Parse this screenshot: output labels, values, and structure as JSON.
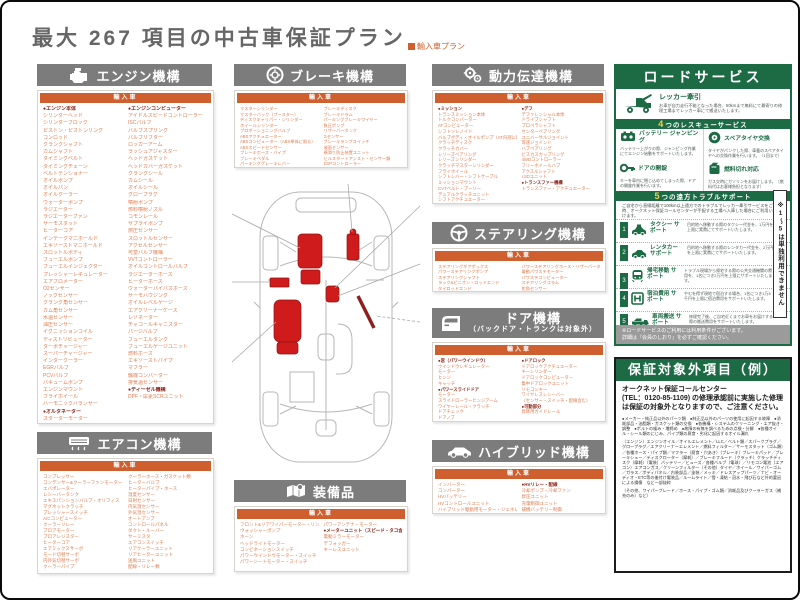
{
  "page": {
    "title": "最大 267 項目の中古車保証プラン",
    "plan_badge": "輸入車プラン"
  },
  "colors": {
    "accent_orange": "#cf5f2e",
    "header_gray": "#7c7c7c",
    "green": "#1d6b45",
    "part_red": "#c61a1a"
  },
  "sections": {
    "engine": {
      "title": "エンジン機構",
      "subheader": "輸入車",
      "col1": [
        "●エンジン本体",
        "シリンダーヘッド",
        "シリンダーブロック",
        "ピストン・ピストンリング",
        "コンロッド",
        "クランクシャフト",
        "カムシャフト",
        "タイミングベルト",
        "タイミングチェーン",
        "ベルトテンショナー",
        "オイルポンプ",
        "オイルパン",
        "オイルクーラー",
        "ウォーターポンプ",
        "ラジエーター",
        "ラジエーターファン",
        "サーモスタット",
        "ヒーターコア",
        "インテークマニホールド",
        "エキゾーストマニホールド",
        "スロットルボディ",
        "フューエルポンプ",
        "フューエルインジェクター",
        "プレッシャーレギュレーター",
        "エアフロメーター",
        "O2センサー",
        "ノックセンサー",
        "クランク角センサー",
        "カム角センサー",
        "水温センサー",
        "油圧センサー",
        "イグニッションコイル",
        "ディストリビューター",
        "ターボチャージャー",
        "スーパーチャージャー",
        "インタークーラー",
        "EGRバルブ",
        "PCVバルブ",
        "バキュームポンプ",
        "エンジンマウント",
        "フライホイール",
        "ハーモニックバランサー",
        "●オルタネーター",
        "スターターモーター"
      ],
      "col2": [
        "●エンジンコンピューター",
        "アイドルスピードコントローラー",
        "ISCバルブ",
        "バルブスプリング",
        "バルブリフター",
        "ロッカーアーム",
        "ラッシュアジャスター",
        "ヘッドガスケット",
        "ヘッドカバーガスケット",
        "クランクシール",
        "カムシール",
        "オイルシール",
        "グロープラグ",
        "噴射ポンプ",
        "燃料噴射ノズル",
        "コモンレール",
        "サプライポンプ",
        "燃圧センサー",
        "スロットルセンサー",
        "アクセルセンサー",
        "可変バルブ機構",
        "VVTコントローラー",
        "オイルコントロールバルブ",
        "ラジエーターホース",
        "ヒーターホース",
        "ウォーターバイパスホース",
        "サーモハウジング",
        "オイルレベルゲージ",
        "エアクリーナーケース",
        "レゾネーター",
        "チャコールキャニスター",
        "パージバルブ",
        "フューエルタンク",
        "フューエルゲージユニット",
        "燃料ホース",
        "エキゾーストパイプ",
        "マフラー",
        "触媒コンバーター",
        "排気温センサー",
        "●ディーゼル機構",
        "DPF・尿素SCRユニット"
      ]
    },
    "brake": {
      "title": "ブレーキ機構",
      "subheader": "輸入車",
      "col1": [
        "マスターシリンダー",
        "マスターバック（ブースター）",
        "ディスクキャリパー・シリンダー",
        "ホイールシリンダー",
        "プロポーショニングバルブ",
        "ABSアクチュエーター",
        "ABSコンピューター（ABS単体に限る）",
        "ABSスピードセンサー",
        "ブレーキホース・パイプ",
        "ブレーキペダル",
        "パーキングブレーキレバー"
      ],
      "col2": [
        "ブレーキディスク",
        "ブレーキドラム",
        "パーキングブレーキワイヤー",
        "負圧ポンプ",
        "リザーバータンク",
        "Gセンサー",
        "ブレーキランプスイッチ",
        "液面センサー",
        "横滑り防止装置ユニット",
        "ヒルスタートアシスト・センサー類",
        "ESPコントローラー"
      ]
    },
    "powertrain": {
      "title": "動力伝達機構",
      "subheader": "輸入車",
      "col1": [
        "●ミッション",
        "トランスミッション本体",
        "トルクコンバーター",
        "ATコンピューター",
        "シフトソレノイド",
        "バルブボディ・オイルポンプ（AT内部に限る）",
        "クラッチディスク",
        "クラッチカバー",
        "レリーズベアリング",
        "レリーズシリンダー",
        "クラッチマスターシリンダー",
        "フライホイール",
        "シフトレバー・シフトケーブル",
        "ミッションマウント",
        "CVTベルト・プーリー",
        "デュアルクラッチユニット",
        "シフトアクチュエーター"
      ],
      "col2": [
        "●デフ",
        "デファレンシャル本体",
        "ドライブシャフト",
        "プロペラシャフト",
        "センターベアリング",
        "ユニバーサルジョイント",
        "等速ジョイント",
        "ハブベアリング",
        "ビスカスカップリング",
        "4WDコントローラー",
        "フリーホイールハブ",
        "アクスルシャフト",
        "LSDユニット",
        "●トランスファー機構",
        "トランスファー・アクチュエーター"
      ]
    },
    "steering": {
      "title": "ステアリング機構",
      "subheader": "輸入車",
      "col1": [
        "ステアリングギアボックス",
        "パワーステアリングポンプ",
        "ステアリングシャフト",
        "ラック&ピニオン・ロッドエンド",
        "タイロッドエンド"
      ],
      "col2": [
        "パワーステアリングホース・リザーバータンク",
        "電動パワステモーター",
        "パワステコンピューター",
        "ステアリングコラム",
        "舵角センサー"
      ]
    },
    "door": {
      "title": "ドア機構",
      "subtitle": "（バックドア・トランクは対象外）",
      "subheader": "輸入車",
      "col1": [
        "●窓（パワーウインドウ）",
        "ウインドウレギュレーター",
        "モーター",
        "ヒンジ",
        "キャッチ",
        "●パワースライドドア",
        "モーター",
        "スライドローラーヒンジアーム",
        "ワイヤーレール・クラッチ",
        "ドアチェック",
        "ドアノブ"
      ],
      "col2": [
        "●ドアロック",
        "ドアロックアクチュエーター",
        "キーシリンダー",
        "ドアロックコンピューター",
        "集中ドアロックユニット",
        "リモコンキー",
        "ワイヤレスレシーバー",
        "（センサー・スイッチ・配線含む）",
        "●可動部分",
        "昇降用ガイドレール"
      ]
    },
    "aircon": {
      "title": "エアコン機構",
      "subheader": "輸入車",
      "col1": [
        "コンプレッサー",
        "コンデンサー&クーラーファンモーター",
        "エバポレーター",
        "レシーバータンク",
        "エキスパンションバルブ・オリフィス",
        "マグネットクラッチ",
        "プレッシャースイッチ",
        "A/Cコンピューター",
        "クーラーリレー",
        "ブロアモーター",
        "ブロアレジスター",
        "ヒーターコア",
        "エアミックスサーボ",
        "モード切替サーボ",
        "内外気切替サーボ",
        "クーラーパイプ"
      ],
      "col2": [
        "クーラーホース・ガスケット類",
        "ヒーターバルブ",
        "ヒーターパイプ・ホース",
        "温度センサー",
        "日射センサー",
        "内気温センサー",
        "外気温センサー",
        "オートアンプ",
        "コントロールパネル",
        "ダクト・ルーバー",
        "サーミスタ",
        "エアコンスイッチ",
        "リアクーラーユニット",
        "リアヒーターユニット",
        "送風ユニット",
        "配線・リレー類"
      ]
    },
    "equipment": {
      "title": "装備品",
      "subheader": "輸入車",
      "col1": [
        "フロント&リアワイパーモーター・リンク",
        "ウォッシャーポンプ",
        "ホーン",
        "ヘッドライトモーター",
        "コンビネーションスイッチ",
        "パワーウインドウモーター・スイッチ",
        "パワーシートモーター・スイッチ"
      ],
      "col2": [
        "パワーアンテナ・モーター",
        "●メーターユニット（スピード・タコ含む）",
        "電動ミラーモーター",
        "デフォッガー",
        "キーレスユニット"
      ]
    },
    "hybrid": {
      "title": "ハイブリッド機構",
      "subheader": "輸入車",
      "col1": [
        "インバーター",
        "コンバーター",
        "HVバッテリー",
        "HVコントロールユニット",
        "ハイブリッド駆動用モーター・ジェネレーター"
      ],
      "col2": [
        "●HVリレー・配線",
        "冷却ポンプ・冷却ファン",
        "昇圧ユニット",
        "充電制御ユニット",
        "補機バッテリー制御"
      ]
    }
  },
  "road_service": {
    "title": "ロードサービス",
    "towing_label": "レッカー牽引",
    "towing_desc": "お車が自力走行不能となった場合、50kmまで無料にて最寄りの修理工場までレッカー車にて搬送いたします。",
    "rescue_num": "4",
    "rescue_title": "つのレスキューサービス",
    "rescue_items": [
      {
        "icon": "battery-icon",
        "label": "バッテリー ジャンピング",
        "desc": "バッテリー上がりの際、ジャンピング作業にてエンジン始動をサポートいたします。"
      },
      {
        "icon": "tire-icon",
        "label": "スペアタイヤ交換",
        "desc": "タイヤがパンクした際、車載のスペアタイヤへの交換作業を行います。（1回まで）"
      },
      {
        "icon": "key-icon",
        "label": "ドアの開錠",
        "desc": "キーを車内に閉じ込めてしまった際、ドアの開錠作業を行います。"
      },
      {
        "icon": "fuel-icon",
        "label": "燃料切れ対応",
        "desc": "ガス欠時にガソリンをお届けします。（燃料代はお客様負担となります）"
      }
    ],
    "trouble_num": "5",
    "trouble_title": "つの遠方トラブルサポート",
    "trouble_intro": "ご自宅から直線距離で100km以上遠方でのトラブルでレッカー牽引サービスをご利用時、オークネット保証コールセンターが手配する工場へ入庫した場合にご利用いただけます。",
    "trouble_items": [
      {
        "num": "1",
        "icon": "taxi-icon",
        "label": "タクシー サポート",
        "desc": "目的地へ移動する際のタクシー代金を、1万円を上限に実費にてサポートいたします。"
      },
      {
        "num": "2",
        "icon": "rentacar-icon",
        "label": "レンタカー サポート",
        "desc": "目的地へ移動する際のレンタカー代金を、2万円を上限に実費にてサポートいたします。"
      },
      {
        "num": "3",
        "icon": "train-icon",
        "label": "帰宅移動 サポート",
        "desc": "トラブル現場から帰宅する際の公共交通機関の費用を、1名につき2万円を上限にサポートいたします。"
      },
      {
        "num": "4",
        "icon": "hotel-icon",
        "label": "宿泊費用 サポート",
        "desc": "やむを得ず現地で宿泊する場合、1名につき1万5千円を上限に宿泊費用をサポートいたします。"
      },
      {
        "num": "5",
        "icon": "carrier-icon",
        "label": "車両搬送 サポート",
        "desc": "修理完了後、ご自宅近くまでお車をお届けする際の搬送費用をサポートいたします。"
      }
    ],
    "side_note": "※1〜5は単独利用できません",
    "footer_note": "※ロードサービスのご利用には利用条件がございます。\n詳細は『会員のしおり』を必ずご確認ください。"
  },
  "exclusions": {
    "title": "保証対象外項目（例）",
    "lead": "オークネット保証コールセンター\n(TEL：0120-85-1109) の修理承認前に実施した修理は保証の対象外となりますので、ご注意ください。",
    "bullets": "●メーカー・純正品以外のパーツ類　●純正品以外のパーツの使用に起因する故障　●消耗部品・油脂類・ガスケット類の交換　●各機構・システムのクリーニング・エア抜き・調整　●ボルトの緩み・増締め　●故障の有無を調べるための点検・分解　●各種オイル・シール類のにじみ、パイプ類の腐食・劣化に起因するオイル漏れ",
    "dense": "（エンジン）エンジンオイル／オイルエレメント／LLC／ベルト類／スパークプラグ／グロープラグ／エアクリーナーエレメント／燃料フィルター／サーモスタット（ゴム類）／各種ホース・パイプ類／マフラー（腐食・穴あき）（ブレーキ）ブレーキパッド／ブレーキシュー／ディスクローター（摩耗）／ブレーキフルード（クラッチ）クラッチディスク（摩耗）（電装）バッテリー／ヒューズ／各種バルブ（電球）／リモコン電池（エアコン）エアコンガス／クリーンフィルター（その他）タイヤ／ホイール／ワイパーゴム／ガラス／ボディパネル／内装部品／塗装／メッキ／ドレスアップパーツ／ナビ・オーディオ・ETC等の後付け電装品／ルームライト／雪・凍結・冠水・飛び石など外的要因による損傷　など一部抜粋",
    "fnote": "（その他、ワイパーブレード／ホース・パイプ・ゴム類／消耗品及びクーラーガス（補充のみ）など）"
  }
}
